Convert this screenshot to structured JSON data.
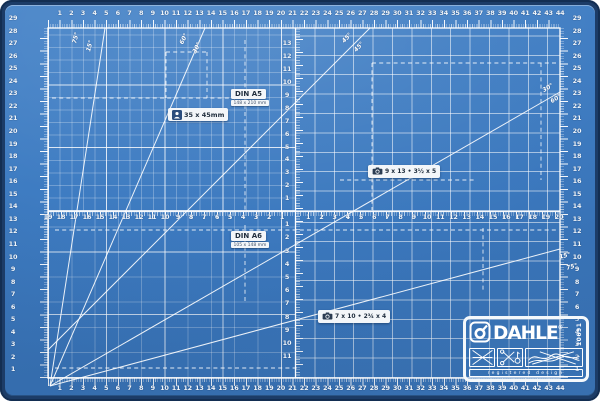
{
  "product": {
    "brand": "DAHLE",
    "registered_mark": "®",
    "model_number": "10691",
    "registered_design_label": "registered design"
  },
  "labels": {
    "passport": {
      "text": "35 x 45mm",
      "icon": "portrait-icon"
    },
    "din_a5": {
      "title": "DIN A5",
      "subtitle": "148 x 210 mm"
    },
    "din_a6": {
      "title": "DIN A6",
      "subtitle": "105 x 148 mm"
    },
    "photo_medium": {
      "text": "9 x 13 • 3½ x 5",
      "icon": "camera-icon"
    },
    "photo_small": {
      "text": "7 x 10 • 2¾ x 4",
      "icon": "camera-icon"
    }
  },
  "angle_labels": [
    {
      "text": "75°",
      "x": 76,
      "y": 38,
      "rot": -75
    },
    {
      "text": "15°",
      "x": 90,
      "y": 46,
      "rot": -75
    },
    {
      "text": "60°",
      "x": 184,
      "y": 39,
      "rot": -63
    },
    {
      "text": "30°",
      "x": 197,
      "y": 48,
      "rot": -63
    },
    {
      "text": "45°",
      "x": 347,
      "y": 38,
      "rot": -47
    },
    {
      "text": "45°",
      "x": 359,
      "y": 47,
      "rot": -47
    },
    {
      "text": "30°",
      "x": 548,
      "y": 88,
      "rot": -31
    },
    {
      "text": "60°",
      "x": 556,
      "y": 99,
      "rot": -31
    },
    {
      "text": "15°",
      "x": 565,
      "y": 256,
      "rot": -15
    },
    {
      "text": "75°",
      "x": 572,
      "y": 267,
      "rot": -15
    }
  ],
  "rulers": {
    "top_numbers": [
      1,
      2,
      3,
      4,
      5,
      6,
      7,
      8,
      9,
      10,
      11,
      12,
      13,
      14,
      15,
      16,
      17,
      18,
      19,
      20,
      21,
      22,
      23,
      24,
      25,
      26,
      27,
      28,
      29,
      30,
      31,
      32,
      33,
      34,
      35,
      36,
      37,
      38,
      39,
      40,
      41,
      42,
      43,
      44
    ],
    "bottom_numbers": [
      1,
      2,
      3,
      4,
      5,
      6,
      7,
      8,
      9,
      10,
      11,
      12,
      13,
      14,
      15,
      16,
      17,
      18,
      19,
      20,
      21,
      22,
      23,
      24,
      25,
      26,
      27,
      28,
      29,
      30,
      31,
      32,
      33,
      34,
      35,
      36,
      37,
      38,
      39,
      40,
      41,
      42,
      43,
      44
    ],
    "left_numbers": [
      29,
      28,
      27,
      26,
      25,
      24,
      23,
      22,
      21,
      20,
      19,
      18,
      17,
      16,
      15,
      14,
      13,
      12,
      11,
      10,
      9,
      8,
      7,
      6,
      5,
      4,
      3,
      2,
      1
    ],
    "right_numbers": [
      29,
      28,
      27,
      26,
      25,
      24,
      23,
      22,
      21,
      20,
      19,
      18,
      17,
      16,
      15,
      14,
      13,
      12,
      11,
      10,
      9,
      8,
      7,
      6,
      5,
      4,
      3,
      2,
      1
    ],
    "mid_left_numbers": [
      19,
      18,
      17,
      16,
      15,
      14,
      13,
      12,
      11,
      10,
      9,
      8,
      7,
      6,
      5,
      4,
      3,
      2,
      1
    ],
    "mid_right_numbers": [
      1,
      2,
      3,
      4,
      5,
      6,
      7,
      8,
      9,
      10,
      11,
      12,
      13,
      14,
      15,
      16,
      17,
      18,
      19,
      20
    ],
    "center_up_numbers": [
      13,
      12,
      11,
      10,
      9,
      8,
      7,
      6,
      5,
      4,
      3,
      2,
      1
    ],
    "center_down_numbers": [
      1,
      2,
      3,
      4,
      5,
      6,
      7,
      8,
      9,
      10,
      11
    ]
  },
  "colors": {
    "mat_surface": "#3b77bd",
    "mat_frame": "#1c3c67",
    "grid_line": "#ffffff",
    "label_background": "#f3f6f9",
    "label_text": "#1f2d3d"
  }
}
